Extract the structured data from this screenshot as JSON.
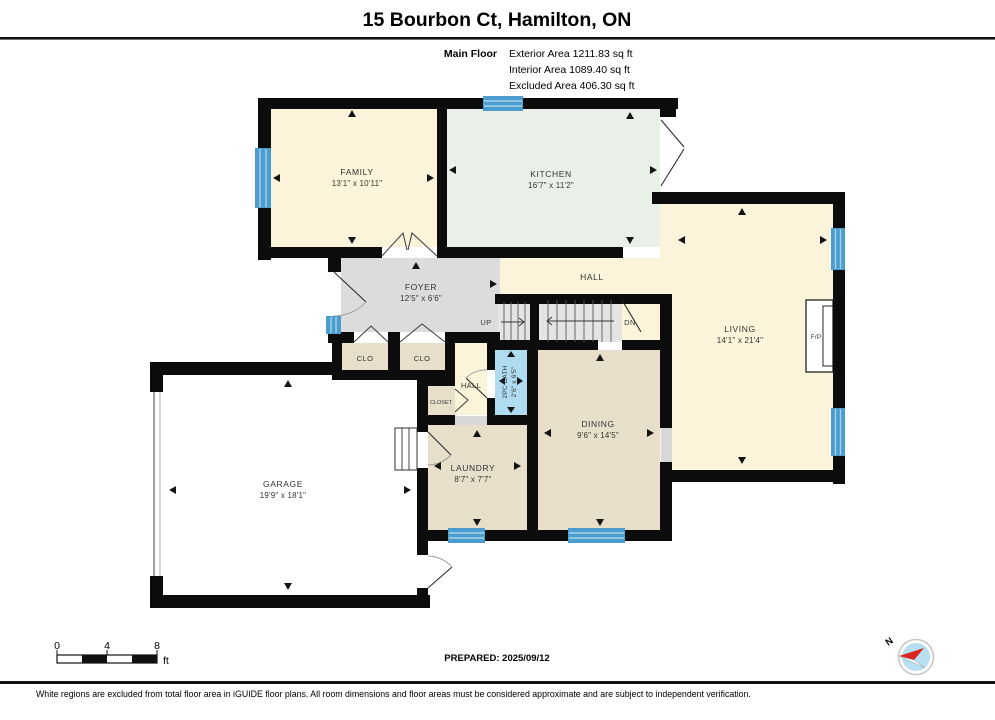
{
  "header": {
    "title": "15 Bourbon Ct, Hamilton, ON",
    "floor_label": "Main Floor",
    "exterior_area": "Exterior Area 1211.83 sq ft",
    "interior_area": "Interior Area 1089.40 sq ft",
    "excluded_area": "Excluded Area 406.30 sq ft"
  },
  "rooms": {
    "family": {
      "name": "FAMILY",
      "dims": "13'1\" x 10'11\""
    },
    "kitchen": {
      "name": "KITCHEN",
      "dims": "16'7\" x 11'2\""
    },
    "living": {
      "name": "LIVING",
      "dims": "14'1\" x 21'4\""
    },
    "foyer": {
      "name": "FOYER",
      "dims": "12'5\" x 6'6\""
    },
    "dining": {
      "name": "DINING",
      "dims": "9'6\" x 14'5\""
    },
    "laundry": {
      "name": "LAUNDRY",
      "dims": "8'7\" x 7'7\""
    },
    "garage": {
      "name": "GARAGE",
      "dims": "19'9\" x 18'1\""
    },
    "bath": {
      "name": "2PC BATH",
      "dims": "2'6\" x 6'5\""
    },
    "hall_upper": "HALL",
    "hall_lower": "HALL",
    "clo_left": "CLO",
    "clo_right": "CLO",
    "closet": "CLOSET",
    "fireplace": "F/P",
    "stairs_up": "UP",
    "stairs_down": "DN"
  },
  "scale_bar": {
    "tick0": "0",
    "tick4": "4",
    "tick8": "8",
    "unit": "ft"
  },
  "footer": {
    "prepared": "PREPARED: 2025/09/12",
    "compass_north": "N",
    "disclaimer": "White regions are excluded from total floor area in iGUIDE floor plans. All room dimensions and floor areas must be considered approximate and are subject to independent verification."
  },
  "colors": {
    "wall": "#0c0c0c",
    "floor_cream": "#fbf4da",
    "floor_mint": "#e8f0e8",
    "floor_tan": "#e8dfca",
    "floor_gray": "#dcdcdc",
    "bath_blue": "#b0dcf2",
    "window_blue": "#4a9dce",
    "compass_red": "#d8251d",
    "compass_blue": "#b6dff2"
  }
}
